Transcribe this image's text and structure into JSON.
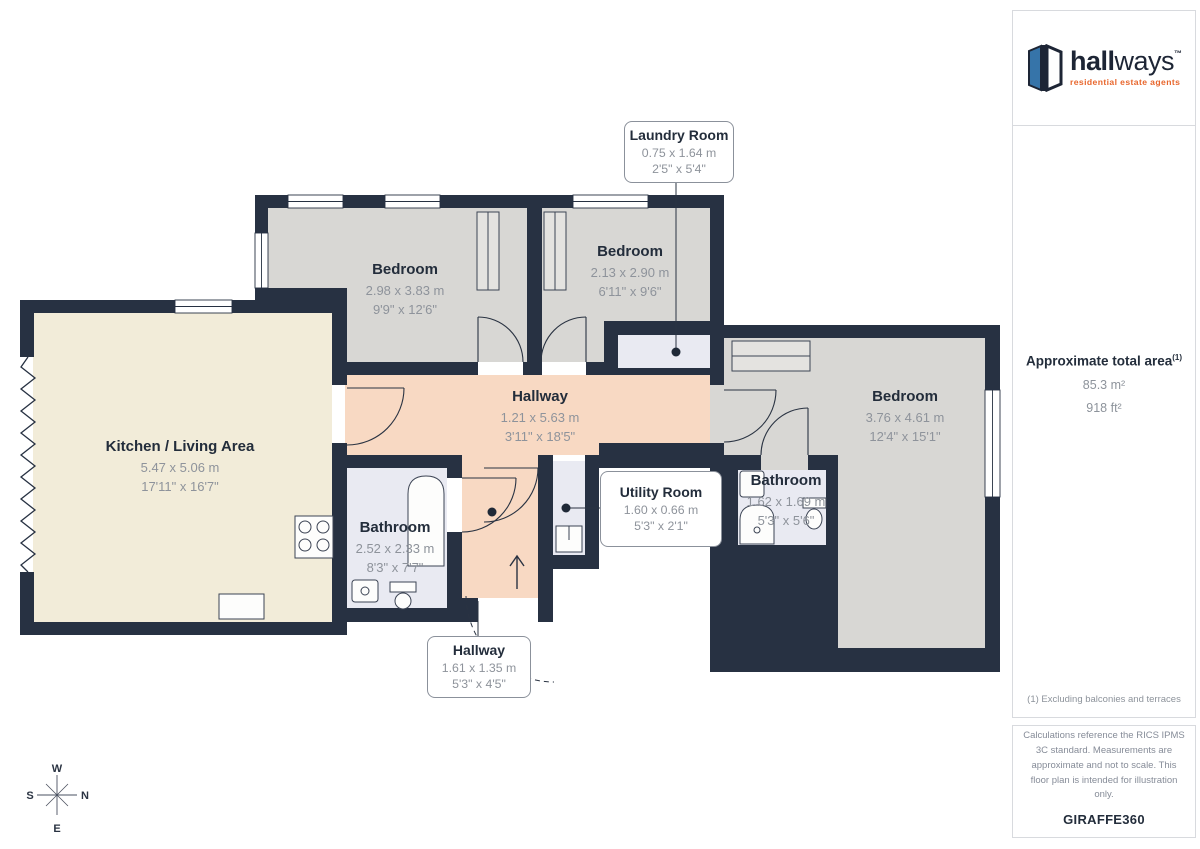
{
  "brand": {
    "bold": "hall",
    "light": "ways",
    "tm": "™",
    "tagline": "residential estate agents"
  },
  "sidebar": {
    "total_area_label": "Approximate total area",
    "total_area_sup": "(1)",
    "area_m2": "85.3 m²",
    "area_ft2": "918 ft²",
    "footnote": "(1) Excluding balconies and terraces",
    "disclaimer": "Calculations reference the RICS IPMS 3C standard. Measurements are approximate and not to scale. This floor plan is intended for illustration only.",
    "provider": "GIRAFFE360"
  },
  "compass": {
    "n": "N",
    "s": "S",
    "e": "E",
    "w": "W"
  },
  "colors": {
    "wall": "#273142",
    "bedroom_floor": "#d8d7d4",
    "kitchen_floor": "#f2ecd9",
    "hallway_floor": "#f8d9c3",
    "bathroom_floor": "#e9eaf2",
    "accent_orange": "#e8662c",
    "logo_blue": "#3674a9"
  },
  "rooms": [
    {
      "name": "Kitchen / Living Area",
      "metric": "5.47 x 5.06 m",
      "imperial": "17'11\" x 16'7\""
    },
    {
      "name": "Bedroom",
      "metric": "2.98 x 3.83 m",
      "imperial": "9'9\" x 12'6\""
    },
    {
      "name": "Bedroom",
      "metric": "2.13 x 2.90 m",
      "imperial": "6'11\" x 9'6\""
    },
    {
      "name": "Bedroom",
      "metric": "3.76 x 4.61 m",
      "imperial": "12'4\" x 15'1\""
    },
    {
      "name": "Hallway",
      "metric": "1.21 x 5.63 m",
      "imperial": "3'11\" x 18'5\""
    },
    {
      "name": "Bathroom",
      "metric": "2.52 x 2.33 m",
      "imperial": "8'3\" x 7'7\""
    },
    {
      "name": "Bathroom",
      "metric": "1.62 x 1.69 m",
      "imperial": "5'3\" x 5'6\""
    },
    {
      "name": "Laundry Room",
      "metric": "0.75 x 1.64 m",
      "imperial": "2'5\" x 5'4\""
    },
    {
      "name": "Utility Room",
      "metric": "1.60 x 0.66 m",
      "imperial": "5'3\" x 2'1\""
    },
    {
      "name": "Hallway",
      "metric": "1.61 x 1.35 m",
      "imperial": "5'3\" x 4'5\""
    }
  ]
}
